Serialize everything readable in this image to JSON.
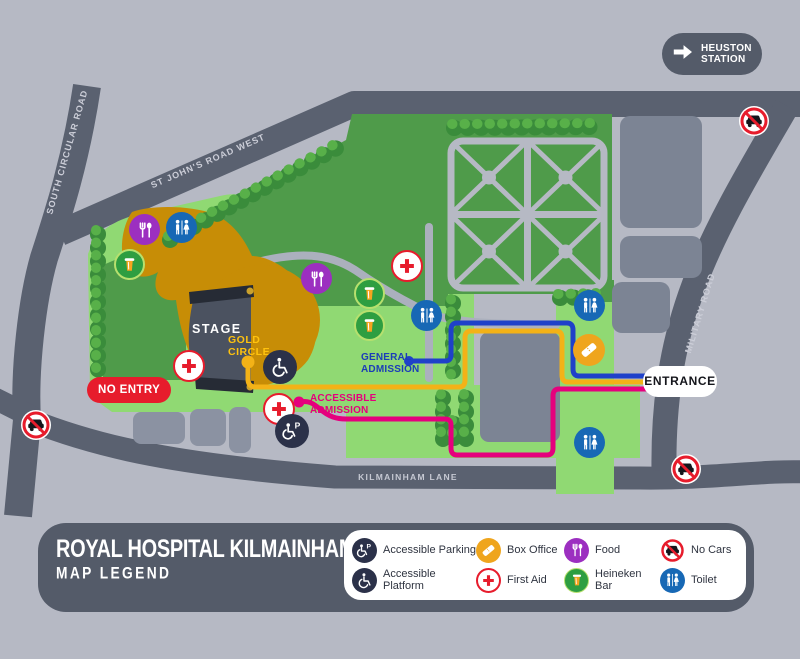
{
  "map": {
    "station_badge": {
      "line1": "HEUSTON",
      "line2": "STATION"
    },
    "roads": {
      "south_circular": "SOUTH CIRCULAR ROAD",
      "st_johns": "ST JOHN'S ROAD WEST",
      "military": "MILITARY ROAD",
      "kilmainham": "KILMAINHAM LANE"
    },
    "stage_label": "STAGE",
    "gold_circle": {
      "line1": "GOLD",
      "line2": "CIRCLE"
    },
    "no_entry": "NO ENTRY",
    "general_admission": {
      "line1": "GENERAL",
      "line2": "ADMISSION"
    },
    "accessible_admission": {
      "line1": "ACCESSIBLE",
      "line2": "ADMISSION"
    },
    "entrance": "ENTRANCE"
  },
  "legend": {
    "title": "ROYAL HOSPITAL KILMAINHAM",
    "subtitle": "MAP LEGEND",
    "items": [
      {
        "icon": "accessible-parking-icon",
        "label": "Accessible Parking"
      },
      {
        "icon": "box-office-icon",
        "label": "Box Office"
      },
      {
        "icon": "food-icon",
        "label": "Food"
      },
      {
        "icon": "no-cars-icon",
        "label": "No Cars"
      },
      {
        "icon": "accessible-platform-icon",
        "label": "Accessible Platform"
      },
      {
        "icon": "first-aid-icon",
        "label": "First Aid"
      },
      {
        "icon": "heineken-bar-icon",
        "label": "Heineken Bar"
      },
      {
        "icon": "toilet-icon",
        "label": "Toilet"
      }
    ]
  },
  "colors": {
    "background": "#b6b9c4",
    "road_gray": "#5a6170",
    "light_green": "#90d973",
    "dark_green": "#4f9b4a",
    "amber_area": "#c78d06",
    "accent_red": "#e71c2c",
    "route_blue": "#1f41c9",
    "route_pink": "#e5007d",
    "route_gold": "#f3b217",
    "food_purple": "#9c2fc0",
    "toilet_blue": "#1768b5",
    "heineken_green": "#2e9e41",
    "box_office_amber": "#efa51d",
    "navy": "#2b3149",
    "panel_gray": "#545b69"
  }
}
